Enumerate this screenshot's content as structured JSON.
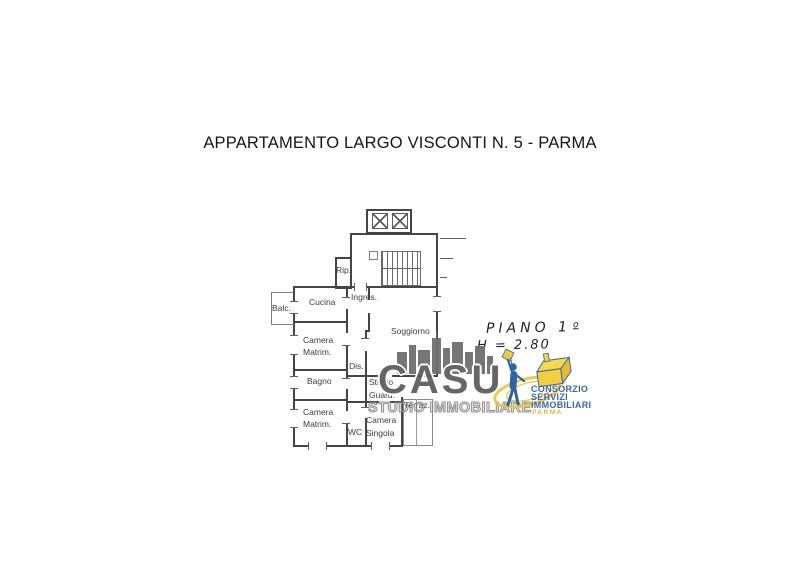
{
  "title": "APPARTAMENTO LARGO VISCONTI N. 5 - PARMA",
  "plan": {
    "rooms": {
      "rip": "Rip.",
      "cucina": "Cucina",
      "ingresso": "Ingres.",
      "balcone": "Balc.",
      "soggiorno": "Soggiorno",
      "camera_matrim_1": {
        "line1": "Camera",
        "line2": "Matrim."
      },
      "disimpegno": "Dis.",
      "bagno": "Bagno",
      "studio_guardaroba": {
        "line1": "Studio",
        "line2": "Guard."
      },
      "camera_matrim_2": {
        "line1": "Camera",
        "line2": "Matrim."
      },
      "wc": "WC",
      "camera_singola": {
        "line1": "Camera",
        "line2": "Singola"
      },
      "terrazzo": "Terraz."
    },
    "annotations": {
      "floor": "PIANO 1",
      "floor_ordinal": "o",
      "ceiling_height": "H = 2.80"
    }
  },
  "watermarks": {
    "casu": {
      "name": "CASU",
      "subtitle": "STUDIO IMMOBILIARE",
      "gray": "#666666"
    },
    "consorzio": {
      "line1": "CONSORZIO",
      "line2": "SERVIZI",
      "line3": "IMMOBILIARI",
      "city": "PARMA",
      "blue": "#3a67ab",
      "yellow": "#e3b52f"
    }
  }
}
